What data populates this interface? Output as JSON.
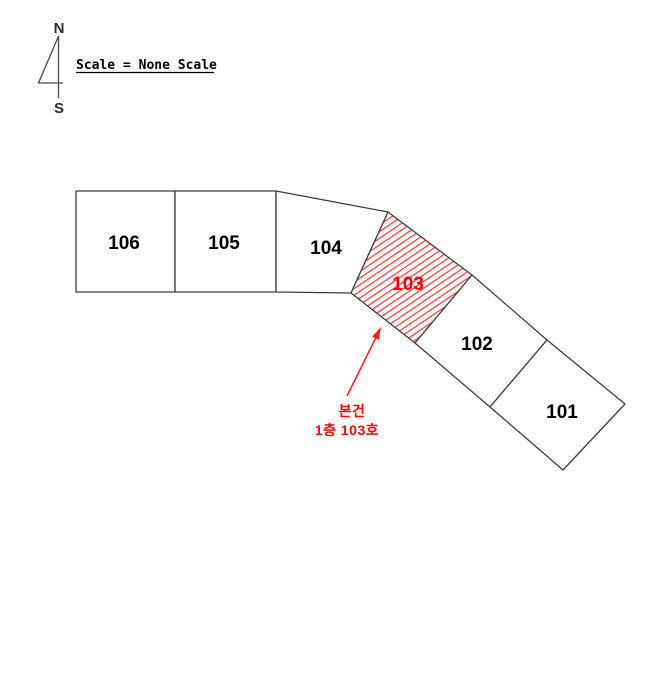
{
  "compass": {
    "north": "N",
    "south": "S"
  },
  "scale_note": "Scale = None Scale",
  "parcels": {
    "units": [
      {
        "label": "106",
        "highlighted": false
      },
      {
        "label": "105",
        "highlighted": false
      },
      {
        "label": "104",
        "highlighted": false
      },
      {
        "label": "103",
        "highlighted": true
      },
      {
        "label": "102",
        "highlighted": false
      },
      {
        "label": "101",
        "highlighted": false
      }
    ],
    "highlighted_unit": "103"
  },
  "annotation": {
    "line1": "본건",
    "line2": "1층 103호"
  },
  "colors": {
    "highlight": "#ff0000",
    "outline": "#3c3c3c",
    "label": "#000000",
    "background": "#ffffff"
  }
}
